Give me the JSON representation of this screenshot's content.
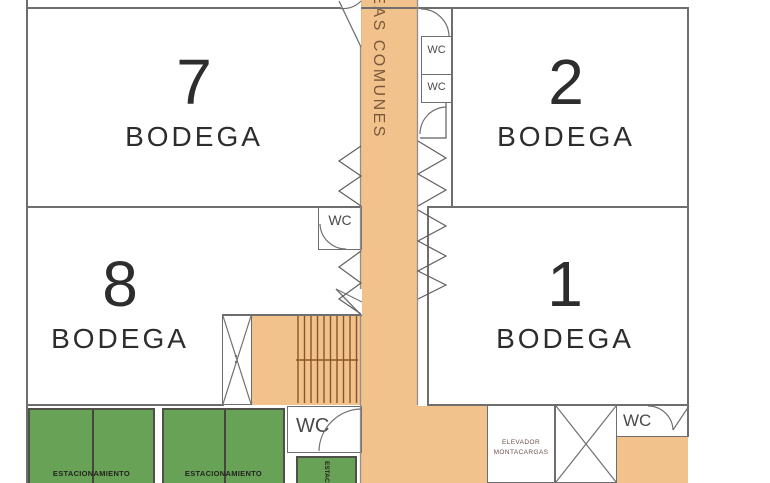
{
  "corridor": {
    "label": "AREAS COMUNES"
  },
  "rooms": {
    "bodega7": {
      "number": "7",
      "type": "BODEGA"
    },
    "bodega2": {
      "number": "2",
      "type": "BODEGA"
    },
    "bodega8": {
      "number": "8",
      "type": "BODEGA"
    },
    "bodega1": {
      "number": "1",
      "type": "BODEGA"
    }
  },
  "wc": {
    "top1": "WC",
    "top2": "WC",
    "mid_left": "WC",
    "bottom_center": "WC",
    "bottom_right": "WC"
  },
  "elevator": {
    "freight_line1": "ELEVADOR",
    "freight_line2": "MONTACARGAS"
  },
  "parking": {
    "left_label": "ESTACIONAMIENTO",
    "center_label": "ESTACIONAMIENTO",
    "small_label": "ESTACIONAMIENTO"
  },
  "colors": {
    "corridor_fill": "#f1c28b",
    "parking_fill": "#68a257",
    "wall": "#6e6e6e",
    "label_text": "#2d2d2d",
    "corridor_text": "#7a573c",
    "stair_line": "#8a5528"
  }
}
